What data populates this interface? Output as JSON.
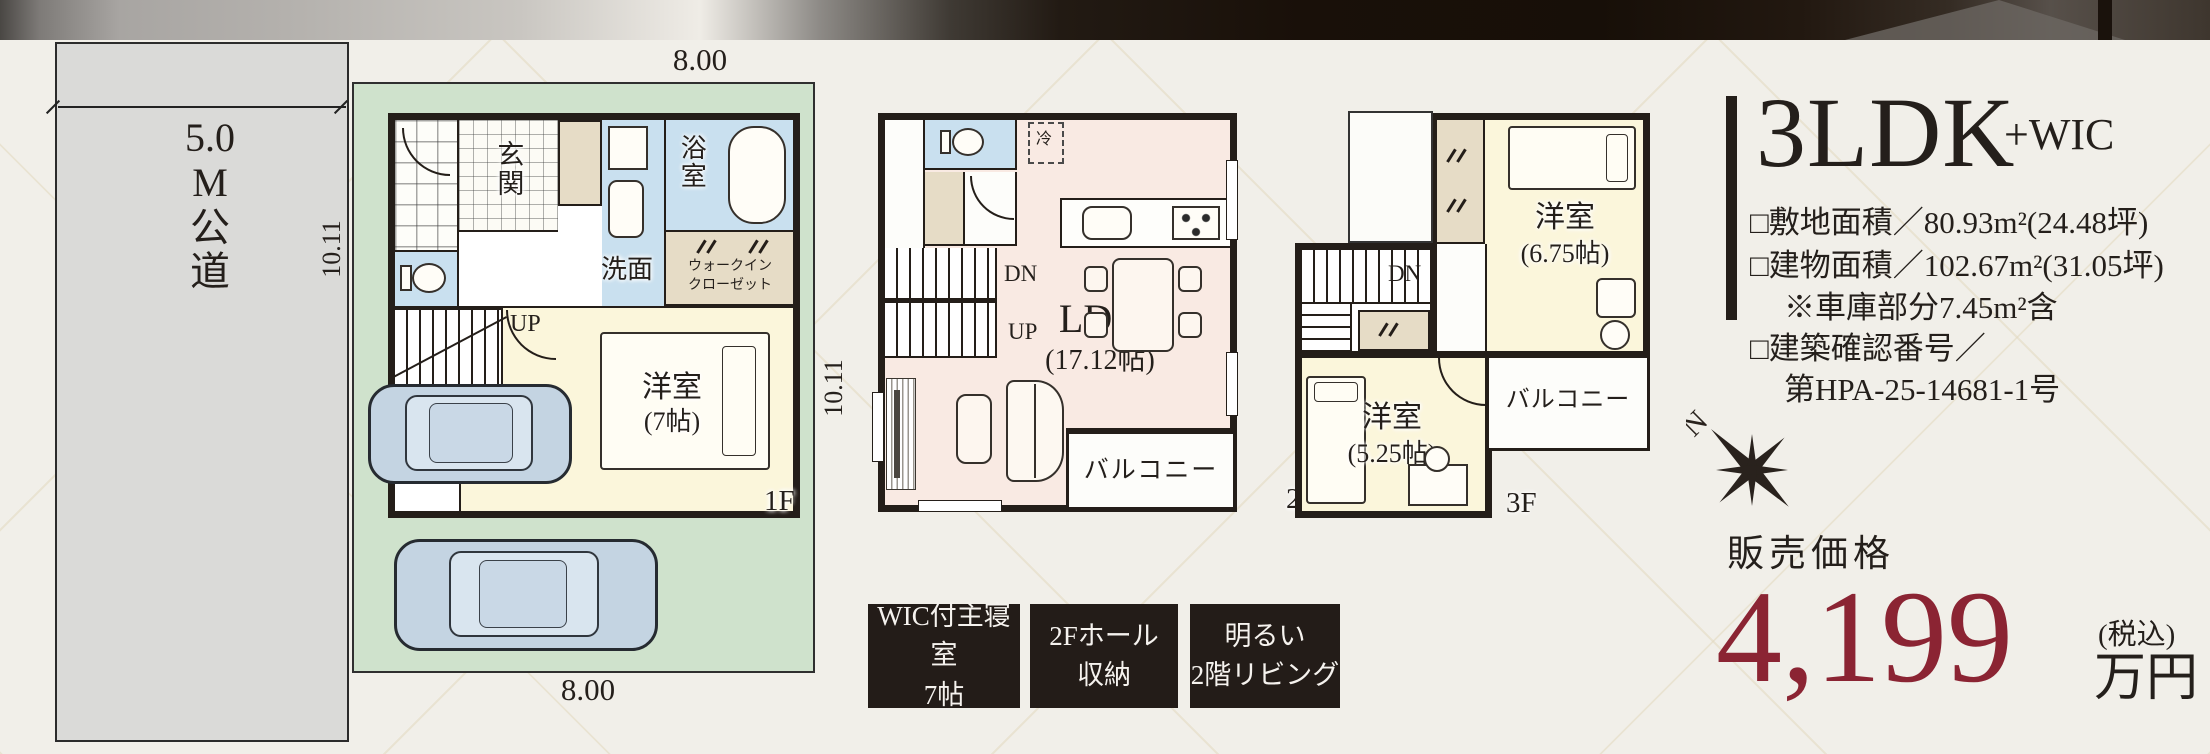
{
  "colors": {
    "paper": "#f1efe9",
    "wall": "#241e19",
    "lot_green": "#cfe2cc",
    "road_gray": "#dadad8",
    "water_blue": "#c9e0ef",
    "closet_tan": "#e6dcc6",
    "bedroom_cream": "#fbf6db",
    "ldk_pink": "#f9eae3",
    "price_red": "#8b2433",
    "badge_bg": "#231c18"
  },
  "road": {
    "label": "5.0\nM\n公\n道"
  },
  "site": {
    "width_top": "8.00",
    "width_bottom": "8.00",
    "depth_left": "10.11",
    "depth_right": "10.11"
  },
  "floor1": {
    "floor_label": "1F",
    "genkan": "玄関",
    "bath": "浴室",
    "wash": "洗面",
    "wic": "ウォークイン\nクローゼット",
    "stairs_up": "UP",
    "bedroom": "洋室",
    "bedroom_size": "(7帖)"
  },
  "floor2": {
    "floor_label": "2F",
    "stairs_down": "DN",
    "stairs_up": "UP",
    "ldk": "LDK",
    "ldk_size": "(17.12帖)",
    "balcony": "バルコニー",
    "fridge": "冷"
  },
  "floor3": {
    "floor_label": "3F",
    "stairs_down": "DN",
    "bedroom_main": "洋室",
    "bedroom_main_size": "(6.75帖)",
    "bedroom_second": "洋室",
    "bedroom_second_size": "(5.25帖)",
    "balcony": "バルコニー"
  },
  "compass": {
    "north": "N"
  },
  "summary": {
    "plan": "3LDK",
    "plan_suffix": "+WIC",
    "details": [
      {
        "text": "□敷地面積／80.93m²(24.48坪)"
      },
      {
        "text": "□建物面積／102.67m²(31.05坪)"
      },
      {
        "text": "※車庫部分7.45m²含"
      },
      {
        "text": "□建築確認番号／"
      },
      {
        "text": "第HPA-25-14681-1号"
      }
    ]
  },
  "price": {
    "label": "販売価格",
    "amount": "4,199",
    "tax_note": "(税込)",
    "unit": "万円"
  },
  "badges": [
    {
      "line1": "WIC付主寝室",
      "line2": "7帖"
    },
    {
      "line1": "2Fホール",
      "line2": "収納"
    },
    {
      "line1": "明るい",
      "line2": "2階リビング"
    }
  ]
}
